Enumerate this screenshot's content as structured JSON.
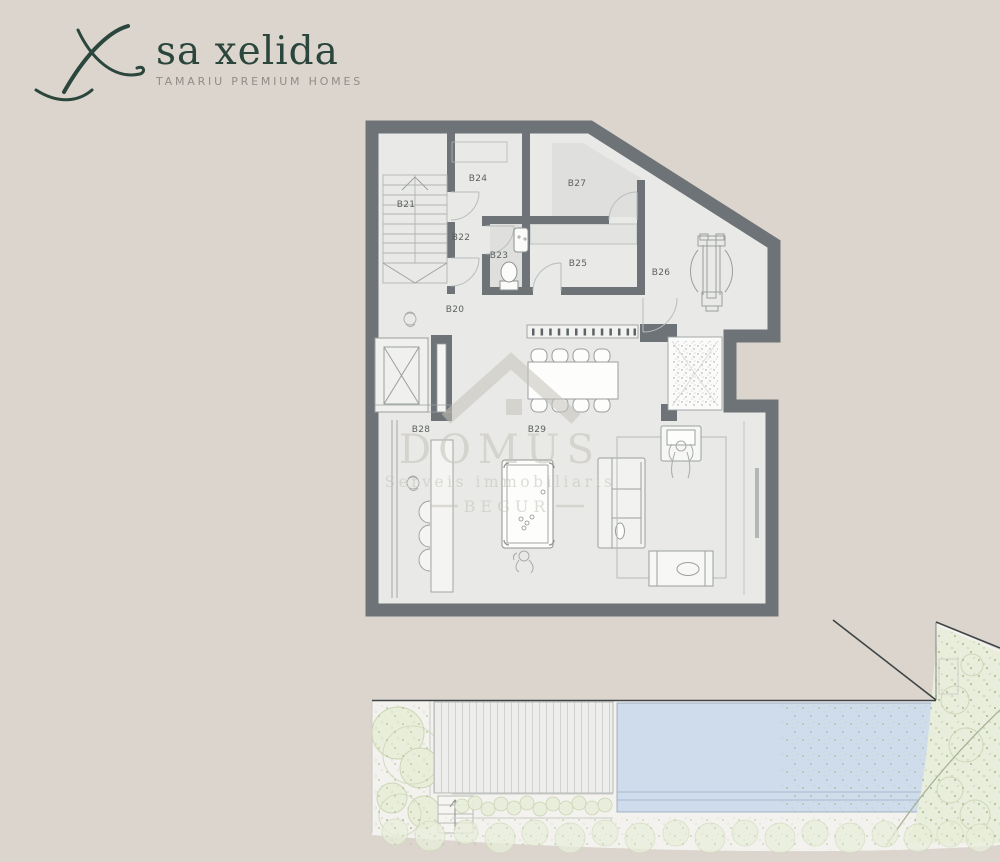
{
  "page": {
    "width": 1000,
    "height": 862,
    "background": "#dcd5ce"
  },
  "logo": {
    "brand": "sa xelida",
    "tagline": "TAMARIU PREMIUM HOMES"
  },
  "watermark": {
    "name": "DOMUS",
    "subtitle": "Serveis immobiliaris",
    "location": "BEGUR"
  },
  "plan": {
    "rooms": [
      {
        "label": "B20"
      },
      {
        "label": "B21"
      },
      {
        "label": "B22"
      },
      {
        "label": "B23"
      },
      {
        "label": "B24"
      },
      {
        "label": "B25"
      },
      {
        "label": "B26"
      },
      {
        "label": "B27"
      },
      {
        "label": "B28"
      },
      {
        "label": "B29"
      }
    ]
  },
  "colors": {
    "background": "#dcd5ce",
    "wall": "#6d7377",
    "floor": "#e9e9e7",
    "shaded_room": "#dfe0dd",
    "pool": "#cedcec",
    "deck": "#ededeb",
    "garden_base": "#f3f2ee",
    "vegetation": "#e9eedc",
    "vegetation_dot": "#a3b785",
    "logo_green": "#2b463c",
    "watermark": "#c6c2ba"
  }
}
